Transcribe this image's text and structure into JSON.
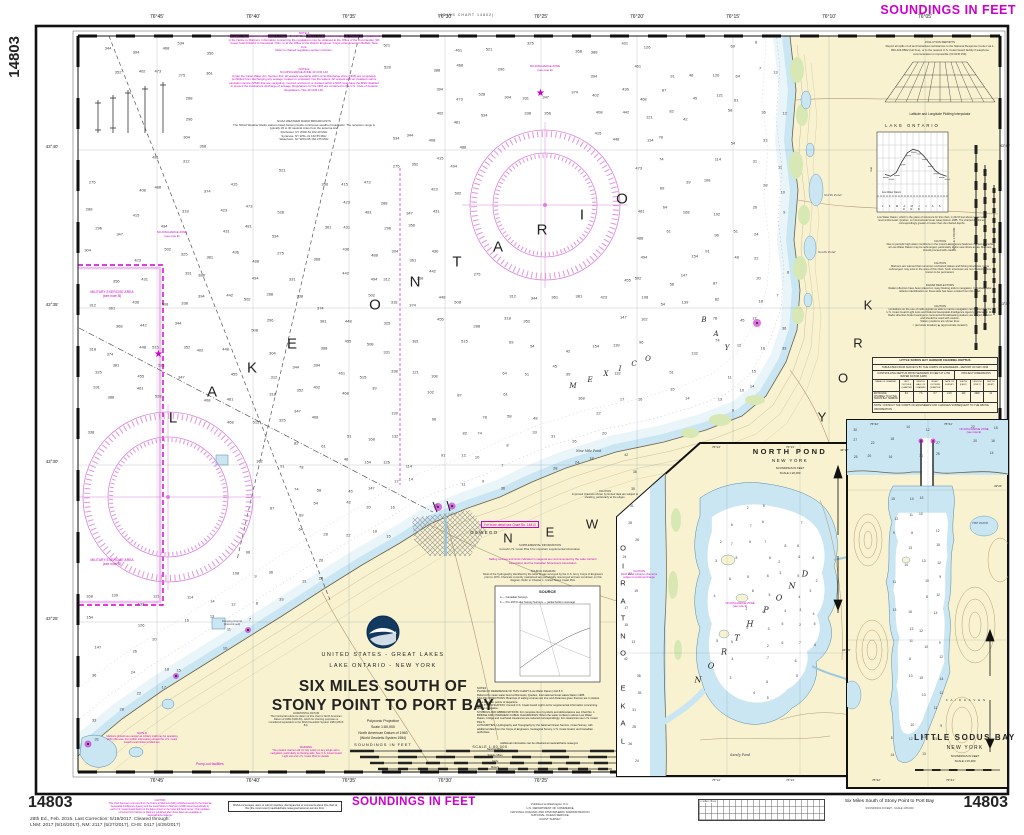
{
  "page": {
    "chart_number": "14803",
    "soundings_banner": "SOUNDINGS IN FEET",
    "joins_top": "(JOINS CHART 14802)"
  },
  "footer": {
    "edition": "28th Ed., Feb. 2015. Last Correction: 5/19/2017. Cleared through:\nLNM: 2017 (5/16/2017), NM: 2117 (5/27/2017), CHS: 0417 (4/29/2017)",
    "caution": "CAUTION\nThis chart has been corrected from the Notice to Mariners (NM) published weekly by the National Geospatial-Intelligence Agency and the Local Notice to Mariners (LNM) issued periodically by each U.S. Coast Guard district to the dates shown in the lower left hand corner. Chart updates corrected from Notices to Mariners published after these dates are available at nauticalcharts.noaa.gov.",
    "noaa_box": "NOAA encourages users to submit inquiries, discrepancies or comments about this chart at this (the most recent) nauticalcharts.noaa.gov/customer-service form.",
    "soundings": "SOUNDINGS IN FEET",
    "publisher": "Published at Washington, D.C.\nU.S. DEPARTMENT OF COMMERCE\nNATIONAL OCEANIC AND ATMOSPHERIC ADMINISTRATION\nNATIONAL OCEAN SERVICE\nCOAST SURVEY",
    "corrections_label": "CORRECTIONS",
    "title": "Six Miles South of Stony Point to Port Bay",
    "subtitle": "SOUNDINGS IN FEET - SCALE 1:80,000"
  },
  "grid": {
    "top_labels": [
      "76°45'",
      "76°40'",
      "76°35'",
      "76°30'",
      "76°25'",
      "76°20'",
      "76°15'",
      "76°10'",
      "76°05'"
    ],
    "bottom_labels": [
      "76°45'",
      "76°40'",
      "76°35'",
      "76°30'",
      "76°25'"
    ],
    "lat_labels": [
      "43°40'",
      "43°35'",
      "43°30'",
      "43°25'"
    ],
    "lat_right": [
      "43°40'",
      "43°35'"
    ]
  },
  "title_block": {
    "line1": "UNITED STATES - GREAT LAKES",
    "line2": "LAKE ONTARIO - NEW YORK",
    "title1": "SIX MILES SOUTH OF",
    "title2": "STONY POINT TO PORT BAY",
    "proj1": "Polyconic Projection",
    "proj2": "Scale 1:80,000",
    "datum1": "North American Datum of 1983",
    "datum2": "(World Geodetic System 1984)",
    "soundings": "SOUNDINGS IN FEET",
    "scale_label": "SCALE  1:80,000",
    "bar_nm": "Nautical Miles",
    "bar_sm": "Statute Miles",
    "bar_yd": "Yards",
    "bar_m": "Meters"
  },
  "notes_left": {
    "note_a": "NOTE A\nNavigation regulations are published in Chapter 2, U.S. Coast Pilot 6. Additions or revisions to Chapter 2 are published in the Notice to Mariners. Information concerning the regulations may be obtained at the Office of the Commander, 9th Coast Guard District in Cleveland, Ohio, or at the Office of the District Engineer, Corps of Engineers in Buffalo, New York.\nRefer to charted regulation section numbers.",
    "note_e": "NOTE E\nNO-DISCHARGE ZONE  40 CFR 140\nUnder the Clean Water Act, Section 312, all vessels operating within a No-Discharge Zone (NDZ) are completely prohibited from discharging any sewage, treated or untreated, into the waters. All vessels with an installed marine sanitation device (MSD) that are navigating, moored, anchored, or docked within a NDZ must have the MSD disabled to prevent the inadvertent discharge of sewage. Regulations for the NDZ are contained in the U.S. Code of Federal Regulations, Title 40 CFR 140.",
    "weather": "NOAA WEATHER RADIO BROADCASTS\nThe NOAA Weather Radio stations listed below provide continuous weather broadcasts. The reception range is typically 20 to 40 nautical miles from the antenna site.\nRochester, NY     WXR-54     162.40 MHz\nSyracuse, NY      WXL-31     162.55 MHz\nWatertown, NY   WXN-96     162.475 MHz"
  },
  "land_notes": {
    "horizontal_datum": "HORIZONTAL DATUM\nThe horizontal reference datum of this chart is North American Datum of 1983 (NAD 83), which for charting purposes is considered equivalent to the World Geodetic System 1984 (WGS 84).",
    "warning": "WARNING\nThe prudent mariner will not rely solely on any single aid to navigation, particularly on floating aids. See U.S. Coast Guard Light List and U.S. Coast Pilot for details.",
    "note_b": "NOTE B\nMariners should use caution as military craft may be operating within the area. For further information consult the U.S. Coast Guard Local Notice to Mariners.",
    "supplemental": "SUPPLEMENTAL INFORMATION\nConsult U.S. Coast Pilot 6 for important supplemental information.",
    "sailing": "Sailing courses and limits indicated in magenta are recommended by the Lake Carriers' Association and the Canadian Shipowners Association.",
    "source_diagram": "SOURCE DIAGRAM\nMost of the hydrography identified by the letter D was surveyed by the U.S. Army Corps of Engineers prior to 1974. Channels currently maintained are periodically resurveyed and are not shown on this diagram. Refer to Chapter 1, United States Coast Pilot.",
    "caution_channels": "CAUTION\nImproved channels shown by limited data are subject to shoaling, particularly at the edges.",
    "detail": "For more detail see Chart No. 14813",
    "pumpout": "Pump-out facilities",
    "notes_main": "NOTES\nPLANE OF REFERENCE OF THIS CHART (Low Water Datum)  242.8 ft\nReferred to mean water level at Rimouski, Quebec, International Great Lakes Datum 1985.\nSAILING DIRECTIONS: Bearings of sailing courses are true and distances given thereon are in statute miles between points of departure.\nAIDS TO NAVIGATION: Consult U.S. Coast Guard Light List for supplemental information concerning aids to navigation.\nSYMBOLS AND ABBREVIATIONS: For complete list of symbols and abbreviations see Chart No. 1.\nBRIDGE AND OVERHEAD CABLE CLEARANCES: When the water surface is above Low Water Datum, bridge and overhead clearances are reduced correspondingly. For clearances see U.S. Coast Pilot 6.\nAUTHORITIES: Hydrography and Topography by the National Ocean Service, Coast Survey, with additional data from the Corps of Engineers, Geological Survey, U.S. Coast Guard, and Canadian authorities.",
    "notes_more": "Additional information can be obtained at nauticalcharts.noaa.gov",
    "source_box_title": "SOURCE",
    "source_row_a": "a — Canadian Surveys",
    "source_row_b": "b — Pre-1974 Lake Survey Surveys — partial bottom coverage"
  },
  "right_panel": {
    "pollution": "POLLUTION REPORTS\nReport all spills of oil and hazardous substances to the National Response Center via 1-800-424-8802 (toll free), or to the nearest U.S. Coast Guard facility if telephone communication is impossible (33 CFR 153).",
    "interp_label": "Latitude and Longitude Plotting Interpolator",
    "lake_chart": {
      "title": "LAKE  ONTARIO",
      "months": "J F M A M J J A S O N D",
      "datum_label": "Low Water Datum",
      "ylab": "Feet",
      "caption": "Low Water Datum, which is the plane of reference for this chart, is 242.8 feet above mean water level at Rimouski, Quebec, on International Great Lakes Datum 1985. The charted depths are correspondingly greater or lesser than the charted depths.",
      "values": [
        1.2,
        1.1,
        1.3,
        1.9,
        2.4,
        2.6,
        2.5,
        2.2,
        1.8,
        1.4,
        1.2,
        1.1
      ]
    },
    "caution_high": "CAUTION\nDue to periodic high water conditions in the Great Lakes, some features charted as visible at Low Water Datum may be submerged, particularly in the near shore areas. Mariners should proceed with caution.",
    "caution_stakes": "CAUTION\nMariners are warned that numerous uncharted stakes and fishing structures, some submerged, may exist in the area of this chart. Such structures are not charted unless known to be permanent.",
    "radar": "RADAR REFLECTORS\nRadar reflectors have been placed on many floating aids to navigation. Individual radar reflector identification on these aids has been omitted from this chart.",
    "caution_radio": "CAUTION\nLimitations on the use of radio signals as aids to marine navigation can be found in the U.S. Coast Guard Light Lists and National Geospatial-Intelligence Agency Publication 117. Radio direction-finder bearings to commercial broadcasting stations are subject to error and should be used with caution.\nStation positions are shown thus:\n○ (accurate location)    ◉ (approximate location)",
    "scale_vert": "SCALE  1:80,000",
    "table": {
      "t1": "LITTLE SODUS BAY HARBOR CHANNEL DEPTHS",
      "t2": "TABULATED FROM SURVEYS BY THE CORPS OF ENGINEERS - REPORT OF MAY 2016",
      "t3": "CONTROLLING DEPTHS FROM SEAWARD IN FEET AT LOW WATER DATUM (LWD)",
      "proj_dim": "PROJECT DIMENSIONS",
      "h_name": "NAME OF CHANNEL",
      "h_l": "LEFT OUTSIDE QUARTER",
      "h_m": "MIDDLE HALF OF CHANNEL",
      "h_r": "RIGHT OUTSIDE QUARTER",
      "h_date": "DATE OF SURVEY",
      "h_w": "WIDTH (FEET)",
      "h_len": "LENGTH (FEET)",
      "h_d": "DEPTH (FEET)",
      "r_name": "ENTRANCE CHANNEL TO LITTLE SODUS BAY HARBOR",
      "r_l": "8.0",
      "r_m": "7.6",
      "r_r": "8.7",
      "r_date": "2-16",
      "r_w": "100",
      "r_len": "2900",
      "r_d": "12",
      "note": "NOTE:  CONSULT THE CORPS OF ENGINEERS FOR CHANGES SUBSEQUENT TO THE ABOVE INFORMATION"
    }
  },
  "insets": {
    "north_pond": {
      "title": "NORTH POND",
      "state": "NEW YORK",
      "sound": "SOUNDINGS IN FEET",
      "scale": "SCALE 1:20,000",
      "lon1": "76°14'",
      "lon2": "76°13'",
      "lat1": "43°17'",
      "lat2": "43°16'",
      "sandy": "Sandy Pond",
      "ndz": "NO-DISCHARGE ZONE\n(see note E)",
      "caution": "CAUTION\nNorth Pond entrance channel is subject to continual change"
    },
    "little_sodus": {
      "title": "LITTLE SODUS BAY",
      "state": "NEW YORK",
      "sound": "SOUNDINGS IN FEET",
      "scale": "SCALE 1:15,000",
      "lon1": "76°42'",
      "lon2": "76°41'",
      "lat1": "43°20'",
      "the_pond": "THE POND",
      "fair_haven": "F A I R   H A V E N",
      "ndz": "NO-DISCHARGE ZONE\n(see note E)"
    }
  },
  "map_words": {
    "lake": "LAKE",
    "ontario": "ONTARIO",
    "new": "NEW",
    "york": "YORK",
    "mexico": "MEXICO",
    "bay": "BAY",
    "north": "NORTH",
    "pond": "POND",
    "lake_ontario_vert": "LAKE ONTARIO"
  },
  "map_labels": {
    "oswego": "OSWEGO",
    "nine_mile": "Nine Mile Point",
    "north_pond_sm": "North Pond",
    "south_pond_sm": "South Pond",
    "military": "MILITARY EXERCISE AREA\n(see note B)",
    "ndz": "NO-DISCHARGE ZONE\n(see note E)",
    "dumping": "Dumping Ground\n(discontinued)"
  },
  "colors": {
    "magenta": "#cc00cc",
    "rose": "#d883d8",
    "land": "#f8f2d0",
    "shallow": "#c9e6f2",
    "marsh": "#d7e8b4"
  },
  "soundings": {
    "deep": [
      275,
      288,
      296,
      304,
      312,
      318,
      325,
      331,
      338,
      344,
      352,
      347,
      356,
      361,
      368,
      374,
      381,
      388,
      394,
      402,
      408,
      415,
      423,
      431,
      436,
      442,
      448,
      455,
      461,
      468,
      473,
      481,
      488,
      494,
      502,
      508,
      515,
      521,
      528,
      534
    ],
    "mid": [
      168,
      154,
      147,
      139,
      132,
      126,
      121,
      114,
      108,
      102,
      96,
      91,
      87,
      82,
      78,
      74,
      69,
      64,
      61,
      58,
      54,
      51,
      48,
      45,
      42,
      39
    ],
    "near": [
      36,
      33,
      31,
      28,
      26,
      24,
      22,
      20,
      18,
      17,
      16,
      15,
      14,
      13,
      12,
      11,
      10,
      9,
      8,
      7
    ],
    "np_lake": [
      42,
      38,
      35,
      31,
      28,
      26,
      24,
      22,
      19,
      17,
      15,
      13
    ],
    "np_pond": [
      2,
      3,
      4,
      5,
      6,
      7,
      8,
      6,
      5,
      4,
      3,
      2,
      7,
      6,
      5,
      8
    ],
    "ls_lake": [
      30,
      27,
      25,
      22,
      20,
      18,
      16,
      14,
      12,
      11
    ],
    "ls_bay": [
      15,
      14,
      13,
      12,
      11,
      10,
      9,
      8,
      12,
      13
    ]
  }
}
